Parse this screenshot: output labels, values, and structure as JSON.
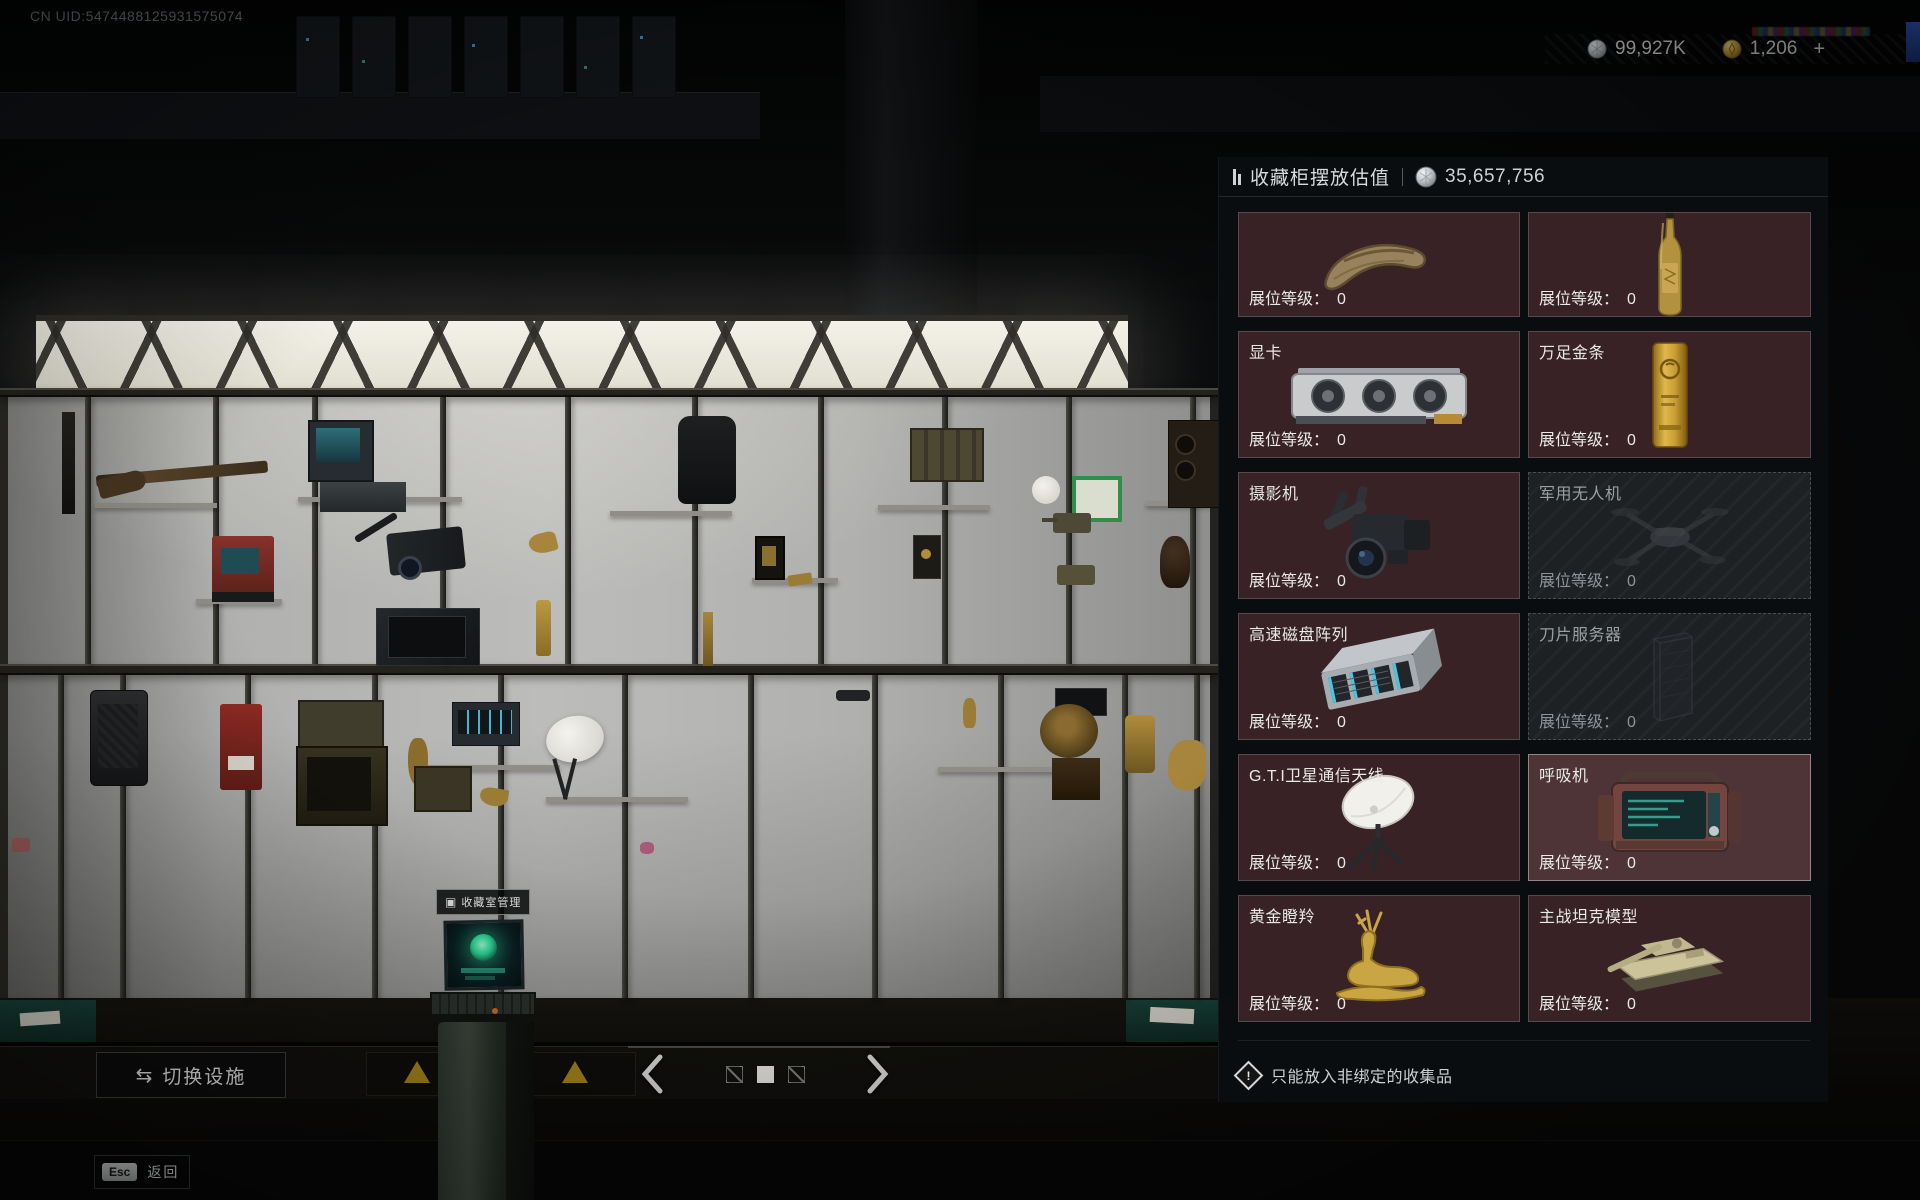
{
  "hud": {
    "uid": "CN UID:5474488125931575074",
    "currencies": [
      {
        "icon": "silver-coin-icon",
        "amount": "99,927K",
        "suffix": ""
      },
      {
        "icon": "gold-coin-icon",
        "amount": "1,206",
        "suffix": "+"
      }
    ]
  },
  "panel": {
    "title": "收藏柜摆放估值",
    "total_value": "35,657,756",
    "level_label": "展位等级：",
    "items": [
      {
        "name": "",
        "art": "dino-claw",
        "level": "0",
        "state": "available"
      },
      {
        "name": "",
        "art": "gold-champagne",
        "level": "0",
        "state": "available"
      },
      {
        "name": "显卡",
        "art": "gpu",
        "level": "0",
        "state": "available"
      },
      {
        "name": "万足金条",
        "art": "gold-bar",
        "level": "0",
        "state": "available"
      },
      {
        "name": "摄影机",
        "art": "video-camera",
        "level": "0",
        "state": "available"
      },
      {
        "name": "军用无人机",
        "art": "drone",
        "level": "0",
        "state": "locked"
      },
      {
        "name": "高速磁盘阵列",
        "art": "disk-array",
        "level": "0",
        "state": "available"
      },
      {
        "name": "刀片服务器",
        "art": "blade-server",
        "level": "0",
        "state": "locked"
      },
      {
        "name": "G.T.I卫星通信天线",
        "art": "satellite-dish",
        "level": "0",
        "state": "available"
      },
      {
        "name": "呼吸机",
        "art": "ventilator",
        "level": "0",
        "state": "highlighted"
      },
      {
        "name": "黄金瞪羚",
        "art": "golden-gazelle",
        "level": "0",
        "state": "available"
      },
      {
        "name": "主战坦克模型",
        "art": "tank-model",
        "level": "0",
        "state": "available"
      }
    ],
    "footer_note": "只能放入非绑定的收集品"
  },
  "scene": {
    "kiosk_label": "收藏室管理"
  },
  "controls": {
    "switch_facility": "切换设施",
    "esc_key": "Esc",
    "back_label": "返回",
    "page_squares": [
      "slashed",
      "filled",
      "slashed"
    ]
  }
}
